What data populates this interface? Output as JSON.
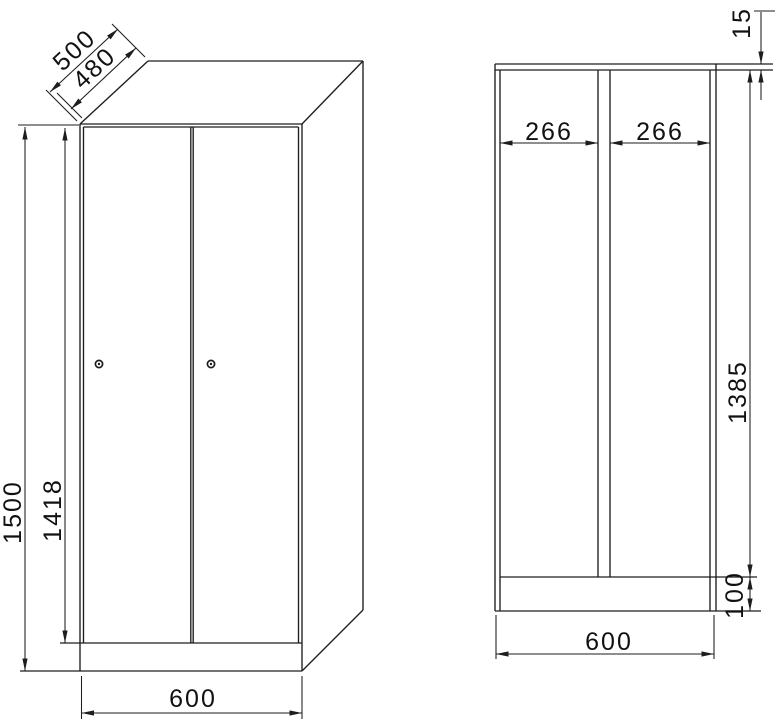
{
  "front_view": {
    "depth_total_mm": "500",
    "depth_body_mm": "480",
    "height_total_mm": "1500",
    "door_height_mm": "1418",
    "width_mm": "600"
  },
  "section_view": {
    "top_panel_mm": "15",
    "compartment_left_mm": "266",
    "compartment_right_mm": "266",
    "interior_height_mm": "1385",
    "plinth_height_mm": "100",
    "width_mm": "600"
  },
  "style": {
    "line_color": "#1d1d1d",
    "text_color": "#111111",
    "background": "#ffffff"
  }
}
